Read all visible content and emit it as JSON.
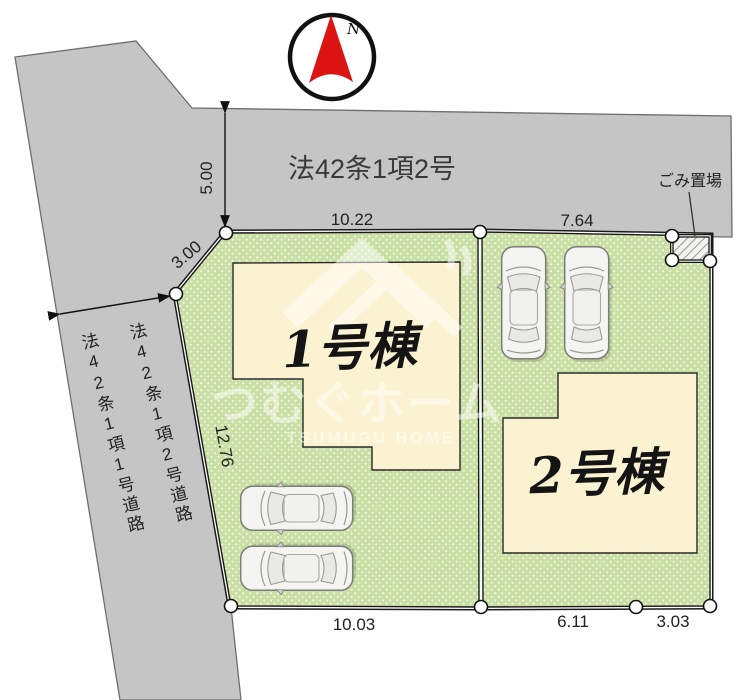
{
  "compass": {
    "label": "N"
  },
  "roads": {
    "top_label": "法42条1項2号",
    "left_label_1": "法42条1項1号道路",
    "left_label_2": "法42条1項2号道路"
  },
  "garbage": {
    "label": "ごみ置場"
  },
  "buildings": {
    "b1": "1号棟",
    "b2": "2号棟"
  },
  "dimensions": {
    "road_width": "5.00",
    "corner_cut": "3.00",
    "lot1_top": "10.22",
    "lot2_top": "7.64",
    "lot1_left": "12.76",
    "lot1_bottom": "10.03",
    "lot2_bottom_left": "6.11",
    "lot2_bottom_right": "3.03"
  },
  "watermark": {
    "jp": "つむぐホーム",
    "en": "TSUMUGU HOME"
  },
  "colors": {
    "road_gray": "#c5c5c5",
    "lot_green": "#cadfa4",
    "building_cream": "#fbf2d2",
    "compass_red": "#dd1512",
    "boundary": "#1a1a1a"
  }
}
